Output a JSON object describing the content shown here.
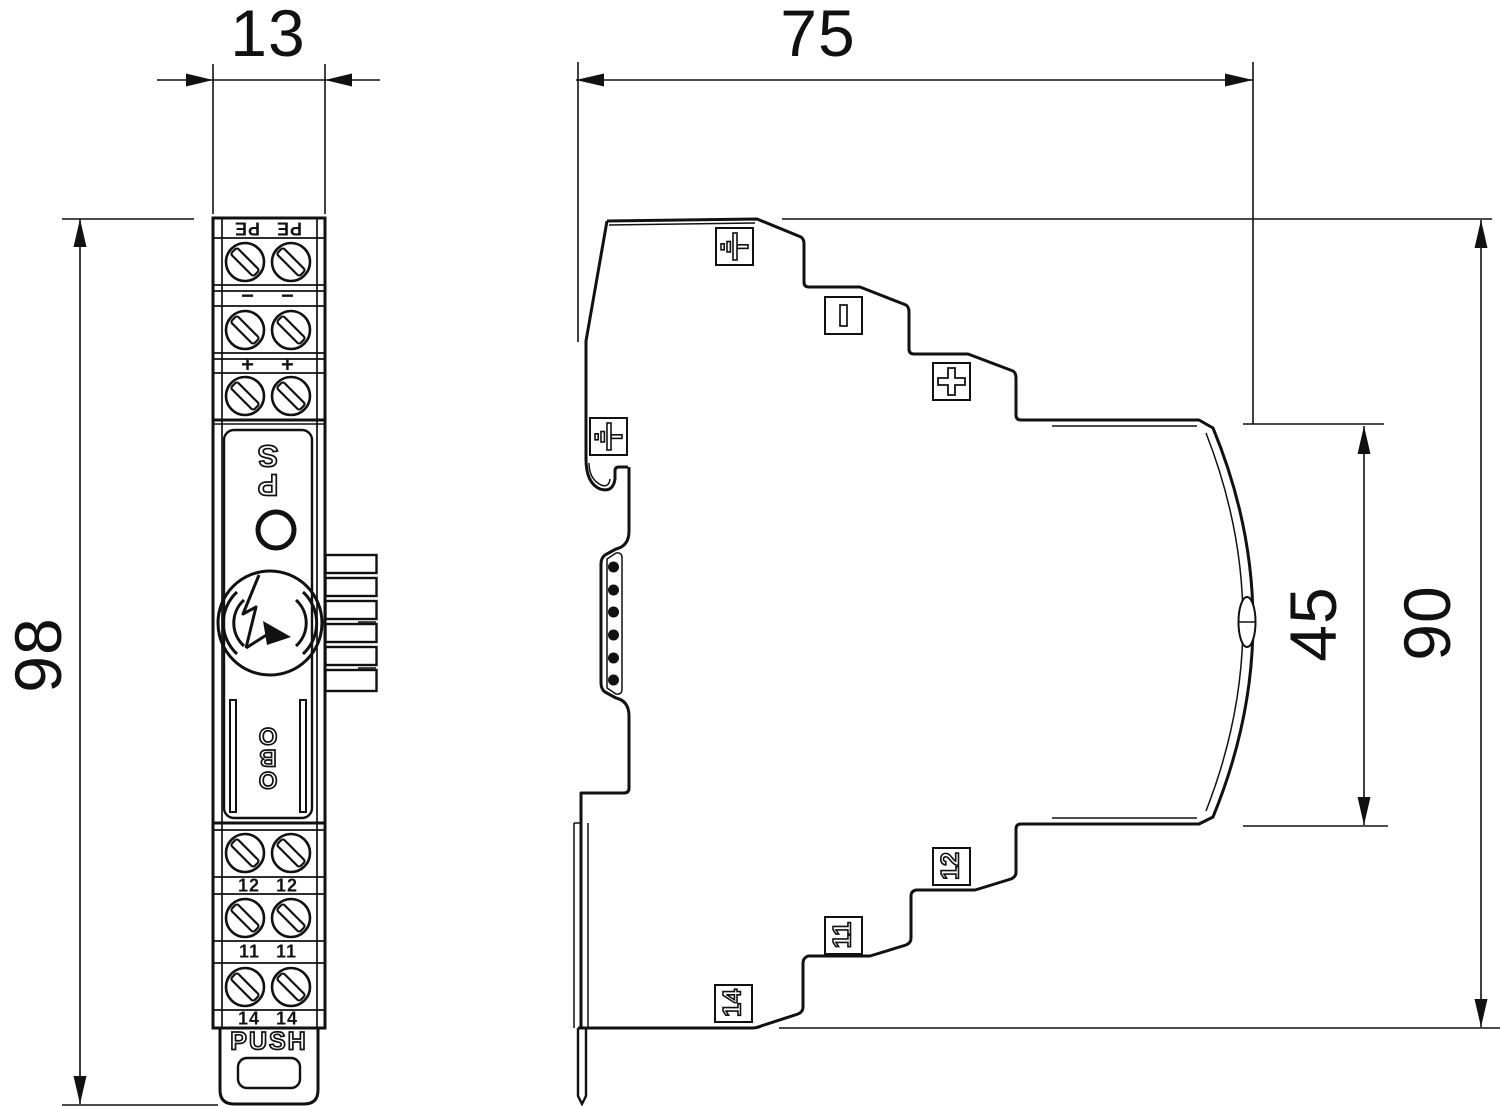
{
  "title": "Dimensional drawing - DIN rail surge protection device, front and side view",
  "colors": {
    "line": "#111111",
    "background": "#ffffff"
  },
  "dimensions": {
    "front_width": "13",
    "front_height": "98",
    "side_width": "75",
    "side_inner_height": "45",
    "side_height": "90"
  },
  "front_view": {
    "pe_left": "PE",
    "pe_right": "PE",
    "minus_left": "−",
    "minus_right": "−",
    "plus_left": "+",
    "plus_right": "+",
    "brand_ps_letters": [
      "P",
      "S"
    ],
    "brand_obo_letters": [
      "O",
      "B",
      "O"
    ],
    "t12_left": "12",
    "t12_right": "12",
    "t11_left": "11",
    "t11_right": "11",
    "t14_left": "14",
    "t14_right": "14",
    "release_label": "PUSH"
  },
  "side_view": {
    "icons_top": [
      "earth-icon",
      "current-bar-icon",
      "plus-icon"
    ],
    "icon_left": "earth-icon",
    "label_12": "12",
    "label_11": "11",
    "label_14": "14"
  }
}
